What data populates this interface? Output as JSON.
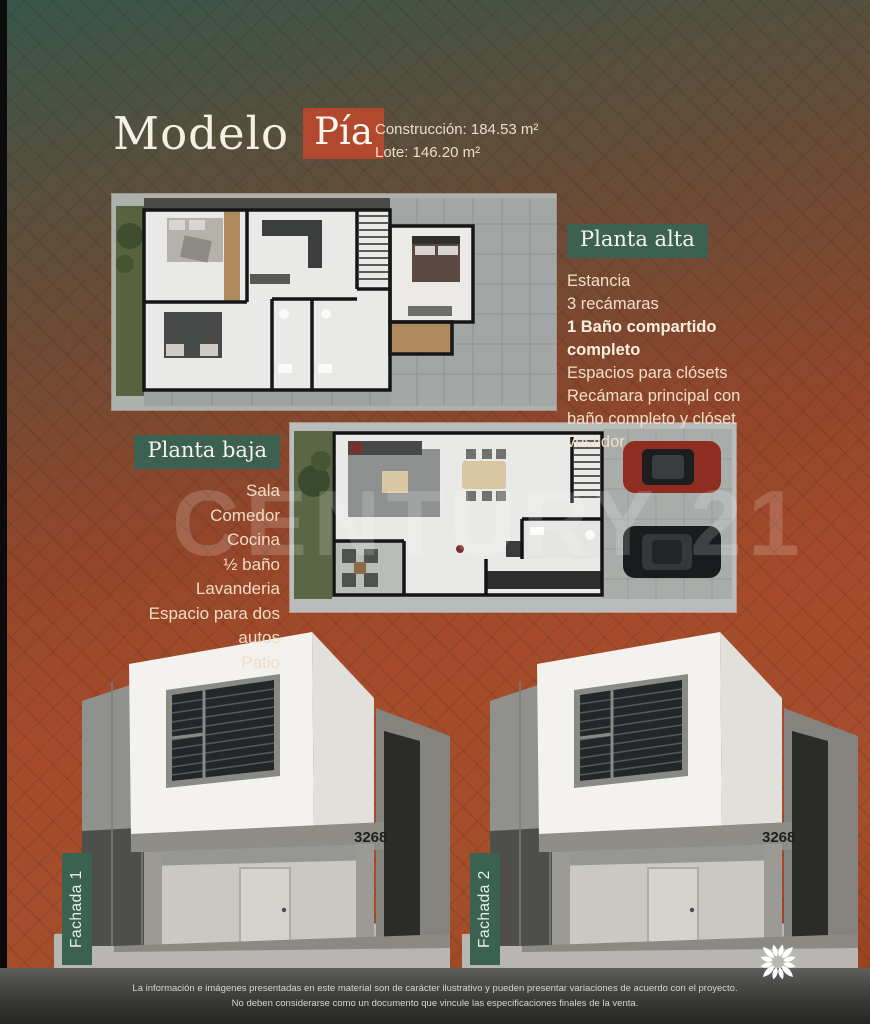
{
  "header": {
    "title_regular": "Modelo",
    "title_highlight": "Pía",
    "construction": "Construcción: 184.53 m²",
    "lot": "Lote: 146.20 m²"
  },
  "planta_alta": {
    "label": "Planta alta",
    "features": [
      {
        "text": "Estancia",
        "bold": false
      },
      {
        "text": "3 recámaras",
        "bold": false
      },
      {
        "text": "1 Baño compartido completo",
        "bold": true
      },
      {
        "text": "Espacios para clósets",
        "bold": false
      },
      {
        "text": "Recámara principal con baño completo y clóset vestidor",
        "bold": false
      }
    ]
  },
  "planta_baja": {
    "label": "Planta baja",
    "features": [
      {
        "text": "Sala",
        "bold": false
      },
      {
        "text": "Comedor",
        "bold": false
      },
      {
        "text": "Cocina",
        "bold": false
      },
      {
        "text": "½ baño",
        "bold": false
      },
      {
        "text": "Lavanderia",
        "bold": false
      },
      {
        "text": "Espacio para dos autos",
        "bold": false
      },
      {
        "text": "Patio",
        "bold": false
      }
    ]
  },
  "fachada_1": {
    "label": "Fachada 1",
    "house_number": "3268"
  },
  "fachada_2": {
    "label": "Fachada 2",
    "house_number": "3268"
  },
  "watermark": "CENTURY 21",
  "footer": {
    "line1": "La información e imágenes presentadas en este material son de carácter ilustrativo y pueden presentar variaciones de acuerdo con el proyecto.",
    "line2": "No deben considerarse como un documento que vincule las especificaciones finales de la venta."
  },
  "colors": {
    "accent_green": "#3c6153",
    "accent_red": "#b2492e",
    "background_green": "#37564b",
    "background_orange": "#a54b2b",
    "text_cream": "#f2dfc9"
  }
}
